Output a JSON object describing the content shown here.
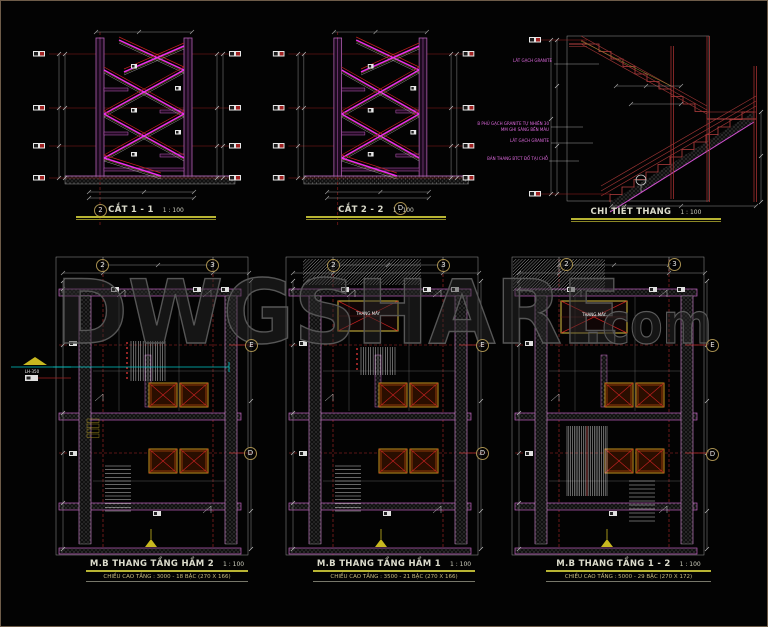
{
  "watermark": {
    "main": "DWGSHARE",
    "suffix": ".com"
  },
  "sections": [
    {
      "title": "CẮT 1 - 1",
      "scale": "1 : 100",
      "grid_marker": "2"
    },
    {
      "title": "CẮT 2 - 2",
      "scale": "1 : 100",
      "grid_marker": "D"
    },
    {
      "title": "CHI TIẾT THANG",
      "scale": "1 : 100",
      "annotations": [
        "LÁT GẠCH GRANITE",
        "B PHỦ GẠCH GRANITE TỰ NHIÊN 30",
        "MM GHI SÁNG BỀN MÀU",
        "LÁT GẠCH GRANITE",
        "BẢN THANG BTCT ĐỔ TẠI CHỖ"
      ]
    }
  ],
  "plans": [
    {
      "title": "M.B THANG TẦNG HẦM 2",
      "scale": "1 : 100",
      "subtitle": "CHIỀU CAO TẦNG : 3000 - 18 BẬC (270 X 166)",
      "grid_top": [
        "2",
        "3"
      ],
      "grid_right": [
        "E",
        "D"
      ],
      "datum_label": "LH-350"
    },
    {
      "title": "M.B THANG TẦNG HẦM 1",
      "scale": "1 : 100",
      "subtitle": "CHIỀU CAO TẦNG : 3500 - 21 BẬC (270 X 166)",
      "grid_top": [
        "2",
        "3"
      ],
      "grid_right": [
        "E",
        "D"
      ],
      "shaft_label": "THANG MÁY"
    },
    {
      "title": "M.B THANG TẦNG 1 - 2",
      "scale": "1 : 100",
      "subtitle": "CHIỀU CAO TẦNG : 5000 - 29 BẬC (270 X 172)",
      "grid_top": [
        "2",
        "3"
      ],
      "grid_right": [
        "E",
        "D"
      ],
      "shaft_label": "THANG MÁY"
    }
  ],
  "colors": {
    "wall": "#c060c0",
    "stair": "#ee2fee",
    "grid_red": "#b02828",
    "cyan": "#00c8c8",
    "yellow": "#b8b433",
    "shaft_frame": "#d8c040"
  }
}
